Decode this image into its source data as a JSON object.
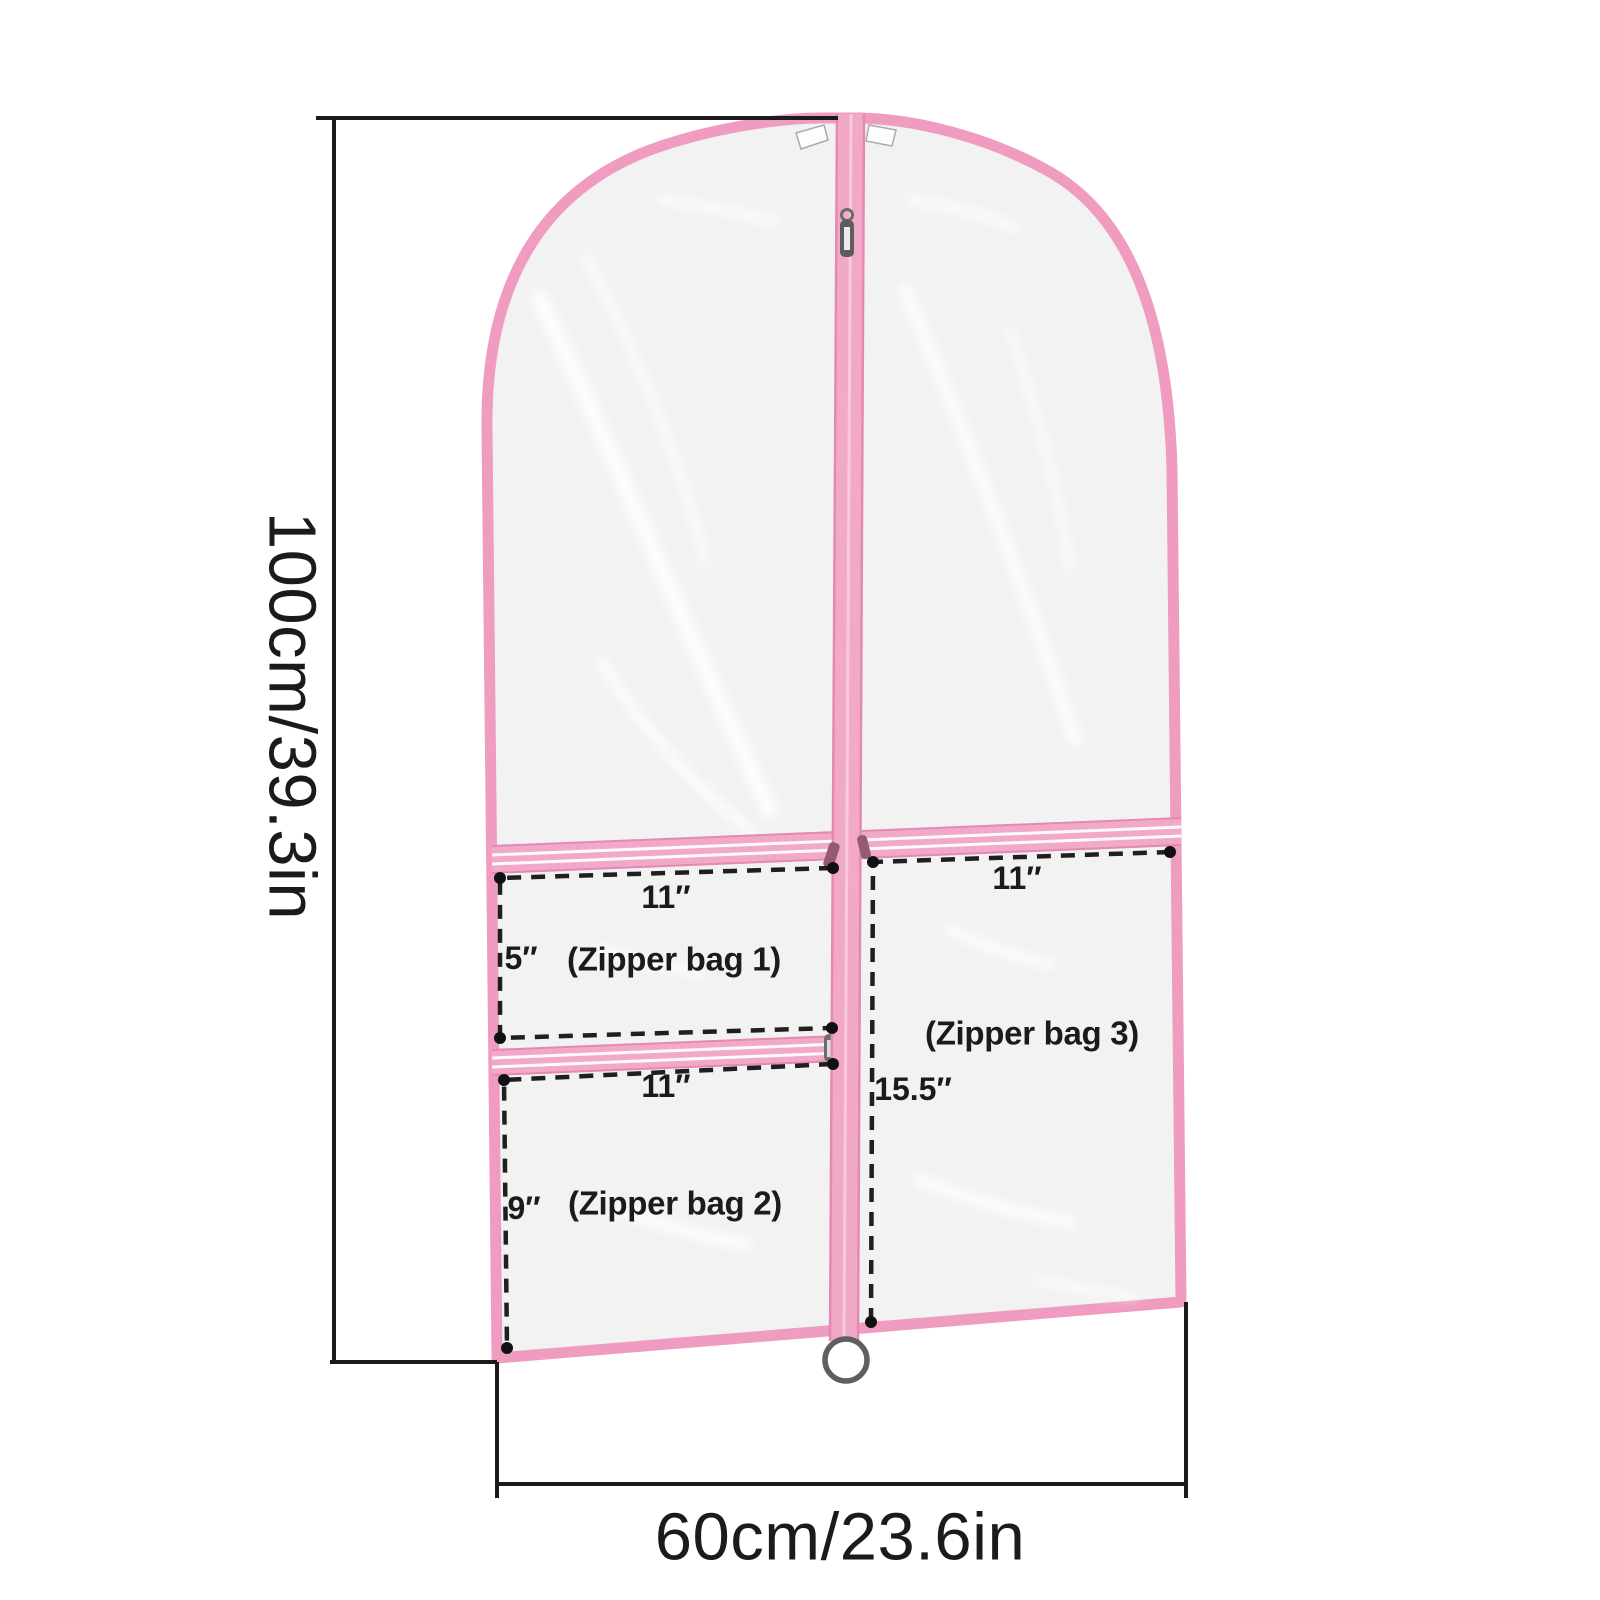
{
  "product_diagram": {
    "overall_height_label": "100cm/39.3in",
    "overall_width_label": "60cm/23.6in",
    "pockets": [
      {
        "name": "(Zipper bag 1)",
        "width": "11″",
        "height": "5″"
      },
      {
        "name": "(Zipper bag 2)",
        "width": "11″",
        "height": "9″"
      },
      {
        "name": "(Zipper bag 3)",
        "width": "11″",
        "height": "15.5″"
      }
    ],
    "colors": {
      "trim_pink": "#ef9cc0",
      "zipper_tape_pink": "#f2a9c8",
      "zipper_edge_pink": "#e389b4",
      "dimension_line": "#1b1b1b",
      "bag_fill": "#f2f2f3"
    }
  }
}
